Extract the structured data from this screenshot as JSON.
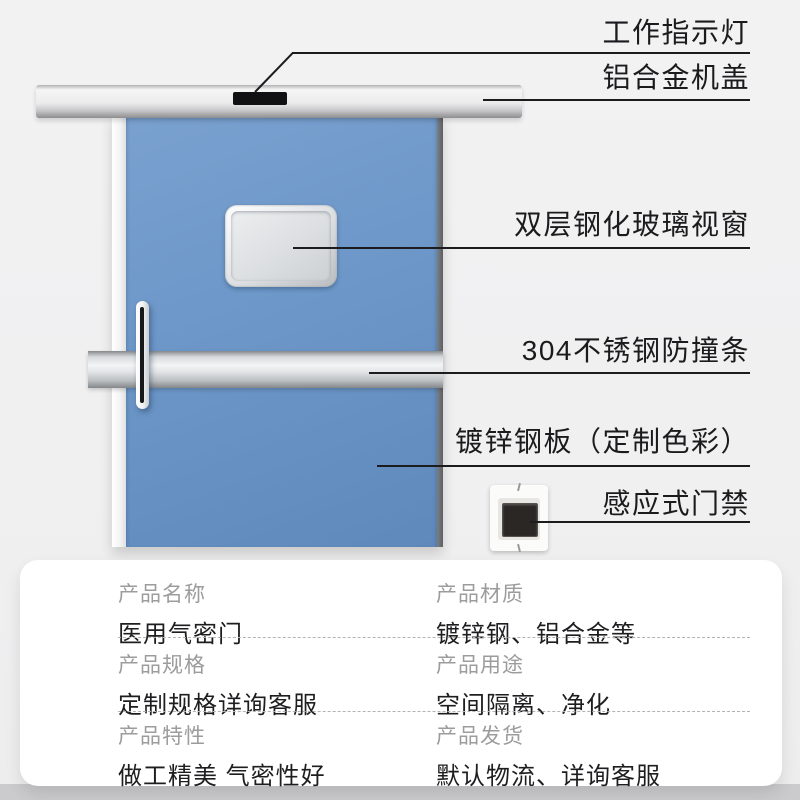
{
  "scene": {
    "callouts": [
      {
        "id": "indicator-light",
        "label": "工作指示灯"
      },
      {
        "id": "aluminum-cover",
        "label": "铝合金机盖"
      },
      {
        "id": "glass-window",
        "label": "双层钢化玻璃视窗"
      },
      {
        "id": "bumper-strip",
        "label": "304不锈钢防撞条"
      },
      {
        "id": "steel-plate",
        "label": "镀锌钢板（定制色彩）"
      },
      {
        "id": "access-control",
        "label": "感应式门禁"
      }
    ]
  },
  "spec_card": {
    "rows": [
      {
        "cells": [
          {
            "label": "产品名称",
            "value": "医用气密门"
          },
          {
            "label": "产品材质",
            "value": "镀锌钢、铝合金等"
          }
        ]
      },
      {
        "cells": [
          {
            "label": "产品规格",
            "value": "定制规格详询客服"
          },
          {
            "label": "产品用途",
            "value": "空间隔离、净化"
          }
        ]
      },
      {
        "cells": [
          {
            "label": "产品特性",
            "value": "做工精美 气密性好"
          },
          {
            "label": "产品发货",
            "value": "默认物流、详询客服"
          }
        ]
      }
    ]
  },
  "colors": {
    "background": "#f1f1f2",
    "door_blue": "#6c97c8",
    "rail_silver": "#ececed",
    "bumper_silver": "#e4e6e8",
    "callout_line": "#1c1c1e",
    "card_bg": "#ffffff",
    "spec_label_gray": "#9c9c9c",
    "text_dark": "#1e1e20",
    "bottom_strip": "#cbcbce"
  }
}
